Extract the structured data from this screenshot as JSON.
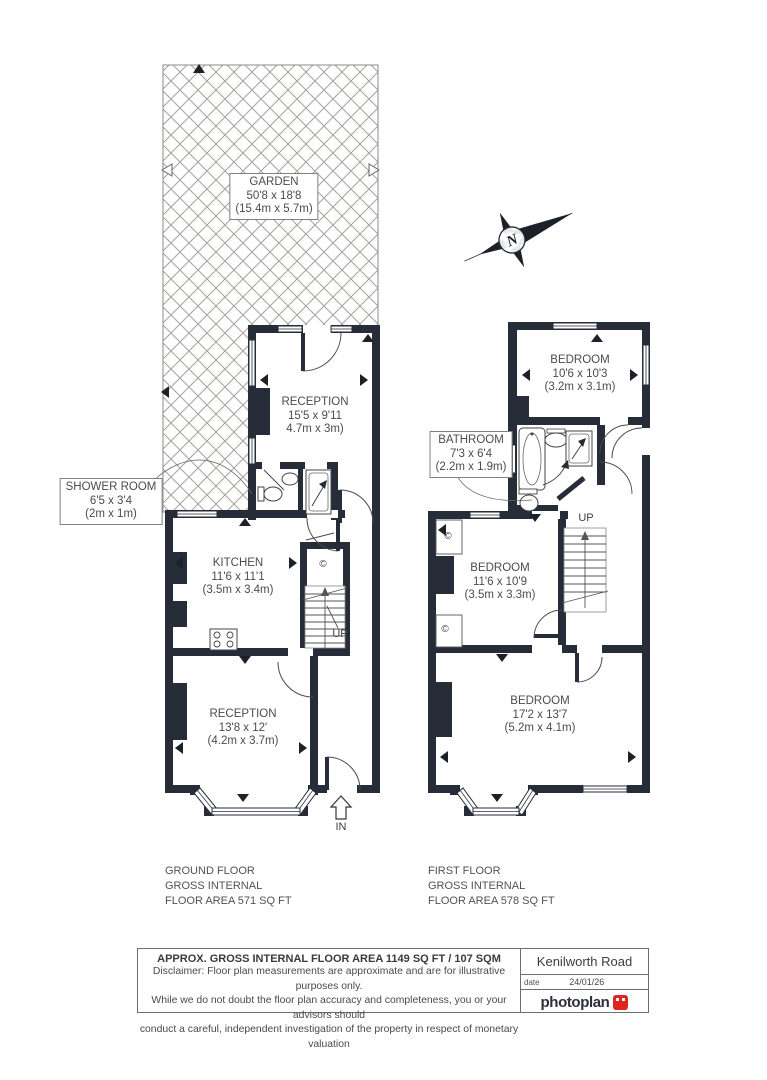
{
  "compass": {
    "north": "N"
  },
  "garden": {
    "label": "GARDEN",
    "size_imperial": "50'8 x 18'8",
    "size_metric": "(15.4m x 5.7m)"
  },
  "ground_floor": {
    "reception_rear": {
      "label": "RECEPTION",
      "size_imperial": "15'5 x 9'11",
      "size_metric": "4.7m x 3m)"
    },
    "shower_room": {
      "label": "SHOWER ROOM",
      "size_imperial": "6'5 x 3'4",
      "size_metric": "(2m x 1m)"
    },
    "kitchen": {
      "label": "KITCHEN",
      "size_imperial": "11'6 x 11'1",
      "size_metric": "(3.5m x 3.4m)"
    },
    "reception_front": {
      "label": "RECEPTION",
      "size_imperial": "13'8 x 12'",
      "size_metric": "(4.2m x 3.7m)"
    },
    "up_label": "UP",
    "in_label": "IN",
    "cupboard_symbol": "©",
    "summary_line1": "GROUND FLOOR",
    "summary_line2": "GROSS INTERNAL",
    "summary_line3": "FLOOR AREA 571 SQ FT"
  },
  "first_floor": {
    "bedroom_rear": {
      "label": "BEDROOM",
      "size_imperial": "10'6 x 10'3",
      "size_metric": "(3.2m x 3.1m)"
    },
    "bathroom": {
      "label": "BATHROOM",
      "size_imperial": "7'3 x 6'4",
      "size_metric": "(2.2m x 1.9m)"
    },
    "bedroom_middle": {
      "label": "BEDROOM",
      "size_imperial": "11'6 x 10'9",
      "size_metric": "(3.5m x 3.3m)"
    },
    "bedroom_front": {
      "label": "BEDROOM",
      "size_imperial": "17'2 x 13'7",
      "size_metric": "(5.2m x 4.1m)"
    },
    "up_label": "UP",
    "cupboard_symbol": "©",
    "summary_line1": "FIRST FLOOR",
    "summary_line2": "GROSS INTERNAL",
    "summary_line3": "FLOOR AREA 578 SQ FT"
  },
  "footer": {
    "title": "APPROX. GROSS INTERNAL FLOOR AREA 1149 SQ FT / 107 SQM",
    "disclaimer_line1": "Disclaimer: Floor plan measurements are approximate and are for illustrative purposes only.",
    "disclaimer_line2": "While we do not doubt the floor plan accuracy and completeness, you or your advisors should",
    "disclaimer_line3": "conduct a careful, independent investigation of the property in respect of monetary valuation",
    "address": "Kenilworth Road",
    "date_label": "date",
    "date_value": "24/01/26",
    "brand": "photoplan"
  },
  "colors": {
    "wall": "#262c38",
    "accent_red": "#e0251e"
  }
}
